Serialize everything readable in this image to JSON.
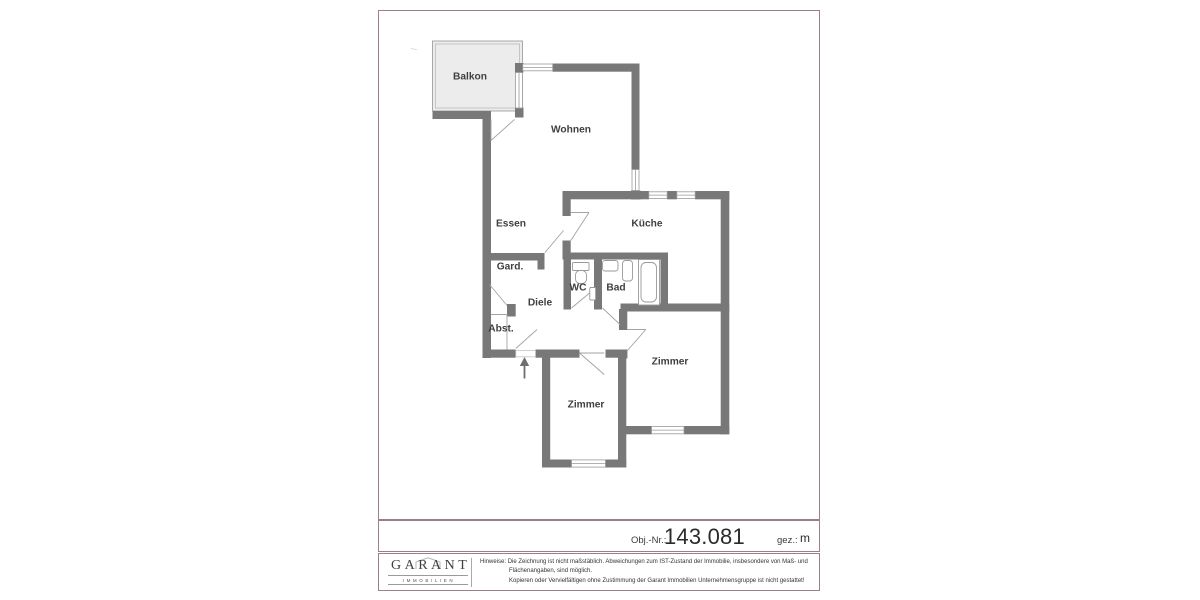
{
  "info": {
    "obj_nr_label": "Obj.-Nr.:",
    "obj_nr_value": "143.081",
    "gez_label": "gez.:",
    "gez_value": "m"
  },
  "rooms": {
    "balkon": "Balkon",
    "wohnen": "Wohnen",
    "essen": "Essen",
    "kueche": "Küche",
    "gard": "Gard.",
    "wc": "WC",
    "bad": "Bad",
    "diele": "Diele",
    "abst": "Abst.",
    "zimmer1": "Zimmer",
    "zimmer2": "Zimmer"
  },
  "plan": {
    "entrance_arrow_icon": "up-arrow",
    "type": "apartment-floorplan"
  },
  "footer": {
    "logo_name": "GARANT",
    "logo_sub": "IMMOBILIEN",
    "logo_house_icon": "house-outline-icon",
    "hint_label": "Hinweise:",
    "hint_line1": "Die Zeichnung ist nicht maßstäblich. Abweichungen zum IST-Zustand der Immobilie, insbesondere von Maß- und",
    "hint_line2": "Flächenangaben, sind möglich.",
    "hint_line3": "Kopieren oder Vervielfältigen ohne Zustimmung der Garant Immobilien Unternehmensgruppe ist nicht gestattet!"
  },
  "colors": {
    "sheet_border": "#9a8084",
    "wall": "#787878",
    "thin_line": "#9a9a9a",
    "balcony_fill": "#ececec",
    "label_text": "#3f3f3f",
    "background": "#ffffff"
  }
}
